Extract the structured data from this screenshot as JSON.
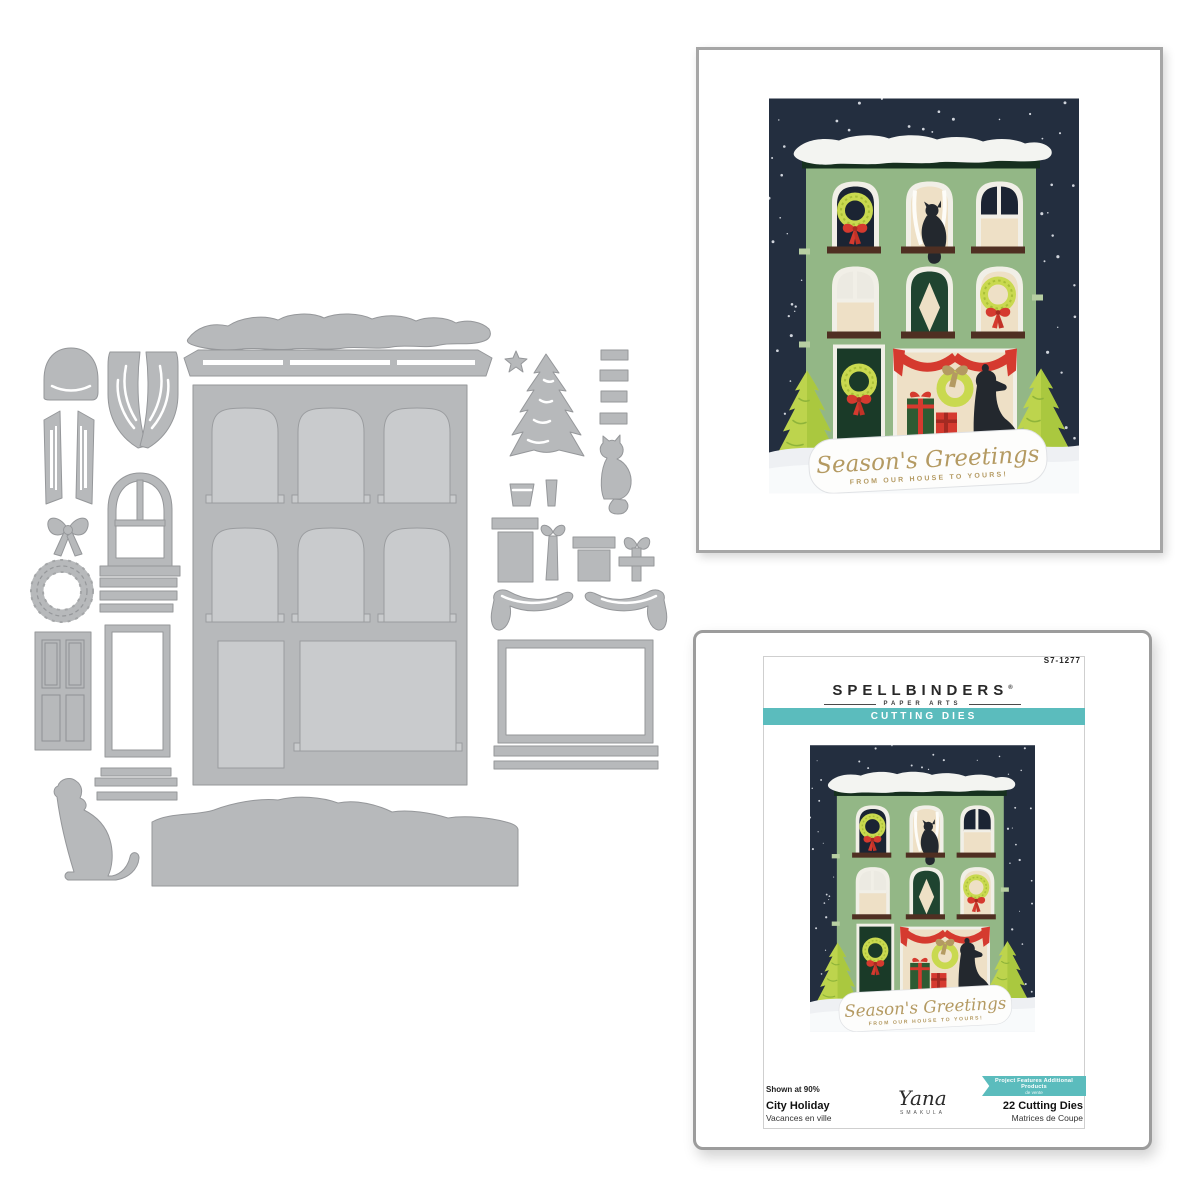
{
  "framed_print": {
    "description": "white gallery frame holding finished holiday card sample"
  },
  "card": {
    "sentiment_script": "Season's Greetings",
    "sentiment_caps": "FROM OUR HOUSE TO YOURS!"
  },
  "package": {
    "product_code": "S7-1277",
    "brand": "SPELLBINDERS",
    "brand_registered": "®",
    "brand_sub": "PAPER ARTS",
    "category_banner": "CUTTING DIES",
    "badge_line1": "Project Features Additional Products",
    "badge_line2": "de vente",
    "shown_at": "Shown at 90%",
    "title": "City Holiday",
    "title_fr": "Vacances en ville",
    "designer_signature": "Yana",
    "designer_sub": "SMAKULA",
    "contents": "22 Cutting Dies",
    "contents_fr": "Matrices de Coupe"
  },
  "die_set": {
    "pieces": [
      "roof-snow",
      "cornice",
      "building-facade",
      "window-shade-dome",
      "curtain-pair",
      "curtain-panel-left",
      "curtain-panel-right",
      "ribbon-bow",
      "arched-window-frame",
      "wreath",
      "steps",
      "paneled-door",
      "window-frame",
      "stoop-platform",
      "stoop-bar",
      "sitting-dog",
      "ground-snow-drift",
      "star",
      "christmas-tree",
      "planter-pot",
      "tree-trunk",
      "blind-slats",
      "sitting-cat",
      "tall-gift-box",
      "gift-ribbon-bow",
      "square-gift-box",
      "bow-cross-ribbon",
      "swag-garland-left",
      "swag-garland-right",
      "storefront-window-frame",
      "storefront-sill",
      "storefront-bar"
    ]
  },
  "colors": {
    "teal": "#5bbcbd",
    "die_gray": "#b7b9bb",
    "die_edge": "#95979a",
    "die_opening": "#c9cbcd",
    "sky_navy": "#232e3f",
    "facade_green": "#93b786",
    "cornice_green": "#16301f",
    "cream": "#eee0c6",
    "window_navy": "#1b2433",
    "curtain_green": "#1f4430",
    "wreath_green": "#c9d94f",
    "wreath_dark": "#a9bf37",
    "bow_red": "#d53a2f",
    "sill_brown": "#4f2f22",
    "tree_light": "#bdd44d",
    "tree_dark": "#8fb43a",
    "animal_dark": "#23282e",
    "sentiment_gold": "#b49a62",
    "snow_white": "#f3f4f1",
    "ground_white": "#eef0f3",
    "frame_border": "#a6a6a6"
  }
}
